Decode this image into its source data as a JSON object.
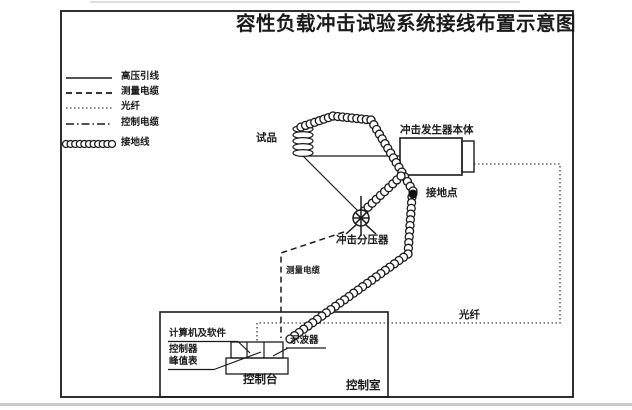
{
  "title": "容性负载冲击试验系统接线布置示意图",
  "legend": {
    "items": [
      {
        "style": "solid",
        "label": "高压引线"
      },
      {
        "style": "dashed",
        "label": "测量电缆"
      },
      {
        "style": "dotted",
        "label": "光纤"
      },
      {
        "style": "dashdot",
        "label": "控制电缆"
      },
      {
        "style": "coil",
        "label": "接地线"
      }
    ]
  },
  "diagram": {
    "labels": {
      "test_sample": "试品",
      "impulse_generator": "冲击发生器本体",
      "ground_point": "接地点",
      "impulse_divider": "冲击分压器",
      "measurement_cable": "测量电缆",
      "optical_fiber": "光纤",
      "computer_software": "计算机及软件",
      "controller": "控制器",
      "peak_meter": "峰值表",
      "oscilloscope": "示波器",
      "control_console": "控制台",
      "control_room": "控制室"
    },
    "colors": {
      "line": "#1a1a1a",
      "background": "#ffffff"
    }
  }
}
